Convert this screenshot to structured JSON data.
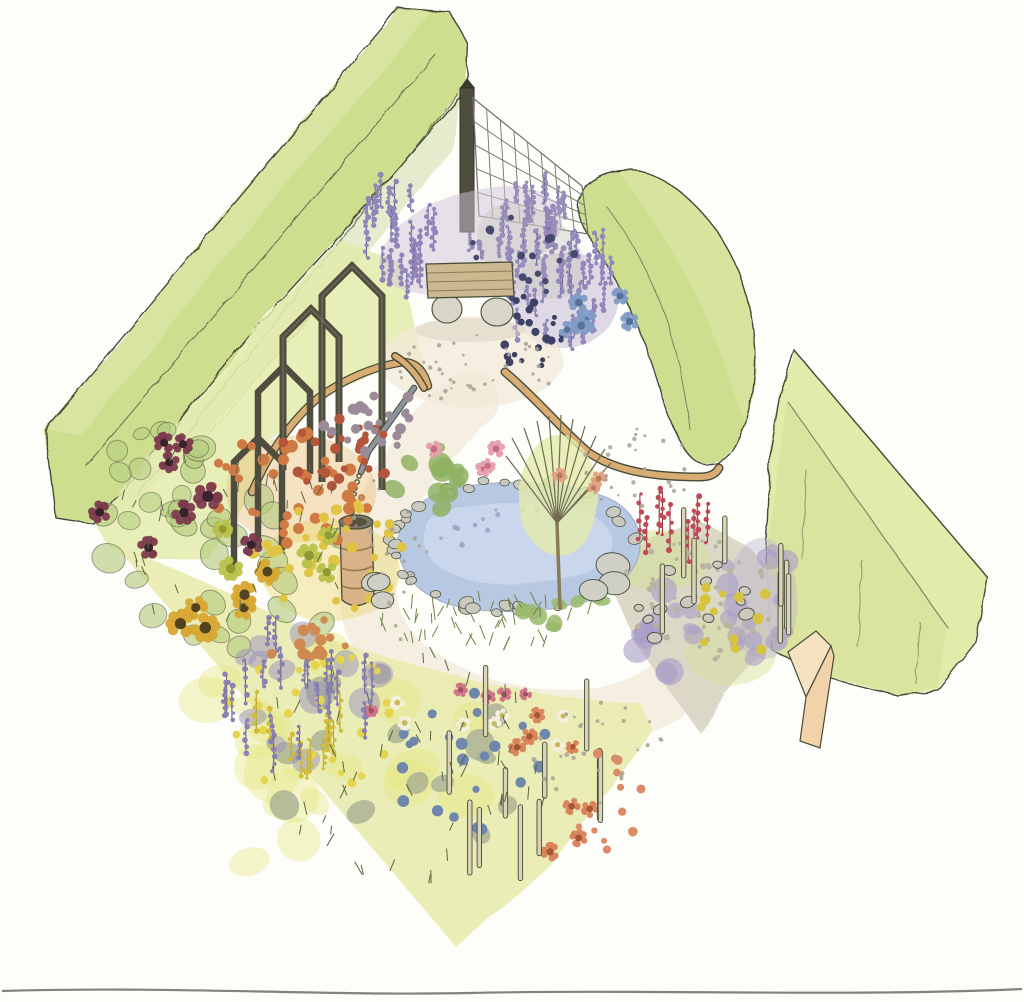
{
  "scene": {
    "description": "watercolor-garden-design-illustration",
    "view": "isometric-diamond-plot"
  },
  "colors": {
    "paper": "#fdfdf9",
    "ink": "#454b38",
    "hedgeMid": "#cede8f",
    "hedgeLight": "#e0eaae",
    "hedgeDark": "#b9cf7b",
    "hedgePale": "#e3ebab",
    "hedgeFace": "#d4e096",
    "wood": "#4f4e3e",
    "woodLight": "#77765f",
    "rail": "#d8ac72",
    "benchWood": "#ccb98f",
    "benchLine": "#8d7c58",
    "stone": "#d9d5c8",
    "barrel": "#d8b488",
    "barrelBand": "#9a7a4e",
    "barrelTop": "#7b7667",
    "pond": "#b7c8e2",
    "pondLight": "#cfdbee",
    "pondLine": "#8291ad",
    "pipe": "#8b939b",
    "wire": "#6e7568",
    "meadow": "#e9ecb0",
    "gravel": "#d9d5c3",
    "plaza": "#f2ead8",
    "pathBand": "#f4efe1",
    "slabTop": "#f6e2c0",
    "slabFront": "#f1d2a9",
    "stake": "#dcd4b6",
    "treeWash": "#e3ecab",
    "trunk": "#8a7a55",
    "branch": "#6e6a4f",
    "scanline": "#73746b",
    "orangeWash": "#e8c07e",
    "yellowWash": "#ecd976",
    "lavenderWash": "#cfc6da",
    "lavenderWash2": "#b9aecd",
    "greyWash": "#c9c3bb"
  },
  "clusters": [
    {
      "layer": "bg",
      "name": "bench-lavender-left",
      "type": "spikes",
      "cx": 400,
      "cy": 250,
      "rx": 46,
      "ry": 48,
      "color": "#8f85b8",
      "color2": "#6b638f",
      "h": 26,
      "count": 26,
      "rmin": 2,
      "rmax": 3
    },
    {
      "layer": "bg",
      "name": "bench-lavender-right",
      "type": "spikes",
      "cx": 556,
      "cy": 298,
      "rx": 58,
      "ry": 62,
      "color": "#9288bb",
      "color2": "#6b638f",
      "h": 28,
      "count": 36,
      "rmin": 2,
      "rmax": 3
    },
    {
      "layer": "bg",
      "name": "fence-slope-sprigs",
      "type": "spikes",
      "cx": 523,
      "cy": 237,
      "rx": 55,
      "ry": 45,
      "color": "#988eb9",
      "color2": "#6f6792",
      "h": 22,
      "count": 24,
      "rmin": 2,
      "rmax": 3
    },
    {
      "layer": "bg",
      "name": "fence-slope-berries",
      "type": "dots",
      "cx": 520,
      "cy": 258,
      "rx": 55,
      "ry": 42,
      "color": "#454a6e",
      "count": 18,
      "rmin": 2.5,
      "rmax": 4.5
    },
    {
      "layer": "bg",
      "name": "bench-berries",
      "type": "dots",
      "cx": 527,
      "cy": 332,
      "rx": 42,
      "ry": 36,
      "color": "#3d4165",
      "count": 26,
      "rmin": 2.5,
      "rmax": 4.5
    },
    {
      "layer": "bg",
      "name": "agapanthus-flowers",
      "type": "daisies",
      "cx": 602,
      "cy": 318,
      "rx": 40,
      "ry": 26,
      "color": "#7f9cc6",
      "color2": "#54719b",
      "count": 6,
      "rmin": 7,
      "rmax": 10
    },
    {
      "layer": "bg",
      "name": "leftbed-leaves",
      "type": "blobs",
      "cx": 215,
      "cy": 560,
      "rx": 130,
      "ry": 115,
      "color": "#b2ca7c",
      "outline": "#4a5138",
      "count": 26,
      "rmin": 9,
      "rmax": 17,
      "opacity": 0.6
    },
    {
      "layer": "bg",
      "name": "leftbed-upper-leaves",
      "type": "blobs",
      "cx": 150,
      "cy": 470,
      "rx": 60,
      "ry": 55,
      "color": "#b3cc7e",
      "outline": "#4a5138",
      "count": 12,
      "rmin": 8,
      "rmax": 13,
      "opacity": 0.55
    },
    {
      "layer": "bg",
      "name": "meadow-yellow-patches",
      "type": "blobs",
      "cx": 340,
      "cy": 760,
      "rx": 170,
      "ry": 125,
      "color": "#e4e77e",
      "count": 20,
      "rmin": 16,
      "rmax": 30,
      "opacity": 0.4
    },
    {
      "layer": "bg",
      "name": "pond-ripples",
      "type": "dots",
      "cx": 500,
      "cy": 528,
      "rx": 70,
      "ry": 22,
      "color": "#93a9c9",
      "count": 12,
      "rmin": 1.5,
      "rmax": 3,
      "opacity": 0.9
    },
    {
      "layer": "bg",
      "name": "pond-stone-ring",
      "type": "ring",
      "cx": 512,
      "cy": 546,
      "rx": 120,
      "ry": 64,
      "color": "#c9c9c0",
      "count": 36,
      "rmin": 4.5,
      "rmax": 8
    },
    {
      "layer": "bg",
      "name": "pond-plants-top",
      "type": "blobs",
      "cx": 425,
      "cy": 480,
      "rx": 58,
      "ry": 34,
      "color": "#8fb163",
      "count": 12,
      "rmin": 7,
      "rmax": 12,
      "opacity": 0.85
    },
    {
      "layer": "bg",
      "name": "pond-plants-bottom",
      "type": "blobs",
      "cx": 560,
      "cy": 608,
      "rx": 60,
      "ry": 24,
      "color": "#9aba6c",
      "count": 10,
      "rmin": 6,
      "rmax": 10,
      "opacity": 0.85
    },
    {
      "layer": "bg",
      "name": "rightbed-lavender",
      "type": "blobs",
      "cx": 685,
      "cy": 635,
      "rx": 75,
      "ry": 48,
      "color": "#a89cc8",
      "count": 16,
      "rmin": 8,
      "rmax": 14,
      "opacity": 0.6
    },
    {
      "layer": "bg",
      "name": "righthedge-lavender",
      "type": "blobs",
      "cx": 757,
      "cy": 600,
      "rx": 42,
      "ry": 60,
      "color": "#a89cc8",
      "count": 12,
      "rmin": 7,
      "rmax": 12,
      "opacity": 0.6
    },
    {
      "layer": "bg",
      "name": "meadow-grey-tufts",
      "type": "blobs",
      "cx": 390,
      "cy": 770,
      "rx": 130,
      "ry": 108,
      "color": "#a9ae94",
      "count": 15,
      "rmin": 9,
      "rmax": 16,
      "opacity": 0.8
    },
    {
      "layer": "bg",
      "name": "meadow-purple-wash",
      "type": "blobs",
      "cx": 302,
      "cy": 700,
      "rx": 85,
      "ry": 72,
      "color": "#9a90bd",
      "count": 12,
      "rmin": 10,
      "rmax": 16,
      "opacity": 0.5
    },
    {
      "layer": "fg",
      "name": "leftbed-orange-flowers",
      "type": "dots",
      "cx": 290,
      "cy": 490,
      "rx": 85,
      "ry": 60,
      "color": "#cf7a43",
      "count": 42,
      "rmin": 3.5,
      "rmax": 6.5
    },
    {
      "layer": "fg",
      "name": "leftbed-rust-flowers",
      "type": "dots",
      "cx": 332,
      "cy": 455,
      "rx": 60,
      "ry": 40,
      "color": "#b5563c",
      "count": 28,
      "rmin": 3,
      "rmax": 5.5
    },
    {
      "layer": "fg",
      "name": "leftbed-yellow-flowers",
      "type": "dots",
      "cx": 330,
      "cy": 560,
      "rx": 80,
      "ry": 62,
      "color": "#e2c445",
      "count": 34,
      "rmin": 3.5,
      "rmax": 6
    },
    {
      "layer": "fg",
      "name": "leftbed-seedheads",
      "type": "dots",
      "cx": 368,
      "cy": 415,
      "rx": 52,
      "ry": 38,
      "color": "#9b8b99",
      "count": 24,
      "rmin": 3,
      "rmax": 5.5
    },
    {
      "layer": "fg",
      "name": "maroon-daisies",
      "type": "daisies",
      "cx": 175,
      "cy": 520,
      "rx": 80,
      "ry": 85,
      "color": "#7c3a4d",
      "color2": "#39222e",
      "count": 8,
      "rmin": 9,
      "rmax": 13
    },
    {
      "layer": "fg",
      "name": "sunflowers",
      "type": "daisies",
      "cx": 230,
      "cy": 600,
      "rx": 75,
      "ry": 46,
      "color": "#d8a832",
      "color2": "#55431f",
      "count": 6,
      "rmin": 9,
      "rmax": 13
    },
    {
      "layer": "fg",
      "name": "pompom-flowers",
      "type": "daisies",
      "cx": 258,
      "cy": 572,
      "rx": 85,
      "ry": 66,
      "color": "#b9c24a",
      "color2": "#8f9a35",
      "count": 5,
      "rmin": 8,
      "rmax": 11
    },
    {
      "layer": "fg",
      "name": "leftbed-stems",
      "type": "ticks",
      "cx": 230,
      "cy": 545,
      "rx": 120,
      "ry": 105,
      "color": "#5c6b42",
      "count": 40,
      "rmin": 7,
      "rmax": 13
    },
    {
      "layer": "fg",
      "name": "pink-flowers",
      "type": "daisies",
      "cx": 470,
      "cy": 455,
      "rx": 42,
      "ry": 15,
      "color": "#e79fae",
      "color2": "#c56e80",
      "count": 4,
      "rmin": 6,
      "rmax": 8
    },
    {
      "layer": "fg",
      "name": "salmon-flowers",
      "type": "daisies",
      "cx": 580,
      "cy": 478,
      "rx": 25,
      "ry": 13,
      "color": "#e0a183",
      "color2": "#b97a5e",
      "count": 3,
      "rmin": 5,
      "rmax": 7
    },
    {
      "layer": "fg",
      "name": "pond-grasses",
      "type": "ticks",
      "cx": 490,
      "cy": 626,
      "rx": 110,
      "ry": 26,
      "color": "#6f8448",
      "count": 46,
      "rmin": 9,
      "rmax": 16
    },
    {
      "layer": "fg",
      "name": "right-boulders",
      "type": "pebbles",
      "cx": 605,
      "cy": 570,
      "rx": 28,
      "ry": 25,
      "color": "#cfcfc6",
      "count": 3,
      "rmin": 14,
      "rmax": 20
    },
    {
      "layer": "fg",
      "name": "left-boulders",
      "type": "pebbles",
      "cx": 392,
      "cy": 585,
      "rx": 22,
      "ry": 20,
      "color": "#cfcfc6",
      "count": 3,
      "rmin": 10,
      "rmax": 15
    },
    {
      "layer": "fg",
      "name": "red-flower-spikes",
      "type": "spikes",
      "cx": 672,
      "cy": 548,
      "rx": 40,
      "ry": 16,
      "color": "#bf4a57",
      "color2": "#8f3642",
      "h": 46,
      "count": 9,
      "rmin": 2,
      "rmax": 3
    },
    {
      "layer": "fg",
      "name": "rightbed-gravel",
      "type": "dots",
      "cx": 700,
      "cy": 600,
      "rx": 85,
      "ry": 60,
      "color": "#b9b3a1",
      "count": 60,
      "rmin": 1.6,
      "rmax": 3.2
    },
    {
      "layer": "fg",
      "name": "rightbed-pebbles",
      "type": "pebbles",
      "cx": 690,
      "cy": 598,
      "rx": 70,
      "ry": 48,
      "color": "#ccc9bd",
      "count": 12,
      "rmin": 4.5,
      "rmax": 8
    },
    {
      "layer": "fg",
      "name": "rightbed-yellow-flowers",
      "type": "dots",
      "cx": 722,
      "cy": 618,
      "rx": 58,
      "ry": 44,
      "color": "#d8c33c",
      "count": 12,
      "rmin": 3.5,
      "rmax": 5.5
    },
    {
      "layer": "fg",
      "name": "rightbed-stakes",
      "type": "stakes",
      "cx": 728,
      "cy": 612,
      "rx": 75,
      "ry": 52,
      "color": "#dcd4b6",
      "h": 62,
      "count": 8,
      "rmin": 2,
      "rmax": 3
    },
    {
      "layer": "fg",
      "name": "meadow-blue-globes",
      "type": "dots",
      "cx": 470,
      "cy": 760,
      "rx": 85,
      "ry": 72,
      "color": "#7087ad",
      "count": 22,
      "rmin": 3.5,
      "rmax": 6
    },
    {
      "layer": "fg",
      "name": "meadow-orange-daisies",
      "type": "daisies",
      "cx": 560,
      "cy": 792,
      "rx": 68,
      "ry": 82,
      "color": "#d9825a",
      "color2": "#a85636",
      "count": 8,
      "rmin": 6,
      "rmax": 8.5
    },
    {
      "layer": "fg",
      "name": "meadow-yellow-dots",
      "type": "dots",
      "cx": 310,
      "cy": 715,
      "rx": 95,
      "ry": 78,
      "color": "#e5d44e",
      "count": 26,
      "rmin": 3,
      "rmax": 5
    },
    {
      "layer": "fg",
      "name": "meadow-pink-daisies",
      "type": "daisies",
      "cx": 445,
      "cy": 700,
      "rx": 110,
      "ry": 16,
      "color": "#cf7287",
      "color2": "#a34f63",
      "count": 5,
      "rmin": 5,
      "rmax": 7
    },
    {
      "layer": "fg",
      "name": "meadow-white-daisies",
      "type": "daisies",
      "cx": 490,
      "cy": 716,
      "rx": 110,
      "ry": 46,
      "color": "#f4f0e2",
      "color2": "#c9ba55",
      "count": 7,
      "rmin": 5,
      "rmax": 7
    },
    {
      "layer": "fg",
      "name": "goldenrod-spikes",
      "type": "spikes",
      "cx": 300,
      "cy": 742,
      "rx": 46,
      "ry": 40,
      "color": "#d2bc3e",
      "color2": "#b3a02e",
      "h": 30,
      "count": 12,
      "rmin": 2,
      "rmax": 3
    },
    {
      "layer": "fg",
      "name": "meadow-stakes",
      "type": "stakes",
      "cx": 520,
      "cy": 812,
      "rx": 105,
      "ry": 82,
      "color": "#dcd4b6",
      "h": 62,
      "count": 11,
      "rmin": 2,
      "rmax": 3
    },
    {
      "layer": "fg",
      "name": "meadow-stems",
      "type": "ticks",
      "cx": 400,
      "cy": 770,
      "rx": 150,
      "ry": 118,
      "color": "#59663f",
      "count": 55,
      "rmin": 8,
      "rmax": 15
    },
    {
      "layer": "fg",
      "name": "meadow-purple-spikes",
      "type": "spikes",
      "cx": 305,
      "cy": 705,
      "rx": 85,
      "ry": 72,
      "color": "#8b80b2",
      "color2": "#675e8c",
      "h": 34,
      "count": 22,
      "rmin": 2,
      "rmax": 3
    },
    {
      "layer": "fg",
      "name": "orange-trail",
      "type": "dots",
      "cx": 300,
      "cy": 642,
      "rx": 55,
      "ry": 26,
      "color": "#d08a4f",
      "count": 14,
      "rmin": 3.5,
      "rmax": 6
    },
    {
      "layer": "fg",
      "name": "meadow-salmon-poppies",
      "type": "dots",
      "cx": 600,
      "cy": 800,
      "rx": 42,
      "ry": 52,
      "color": "#dd8a66",
      "count": 12,
      "rmin": 3,
      "rmax": 5
    },
    {
      "layer": "fg",
      "name": "plaza-specks",
      "type": "dots",
      "cx": 475,
      "cy": 370,
      "rx": 80,
      "ry": 36,
      "color": "#a9a292",
      "count": 40,
      "rmin": 1.2,
      "rmax": 2.4,
      "opacity": 0.85
    },
    {
      "layer": "fg",
      "name": "path-specks-left",
      "type": "dots",
      "cx": 388,
      "cy": 560,
      "rx": 42,
      "ry": 85,
      "color": "#a9a292",
      "count": 24,
      "rmin": 1.2,
      "rmax": 2.4,
      "opacity": 0.85
    },
    {
      "layer": "fg",
      "name": "path-specks-upper-right",
      "type": "dots",
      "cx": 640,
      "cy": 470,
      "rx": 60,
      "ry": 42,
      "color": "#a9a292",
      "count": 26,
      "rmin": 1.2,
      "rmax": 2.4,
      "opacity": 0.85
    },
    {
      "layer": "fg",
      "name": "path-specks-bottom",
      "type": "dots",
      "cx": 600,
      "cy": 748,
      "rx": 68,
      "ry": 55,
      "color": "#a9a292",
      "count": 30,
      "rmin": 1.2,
      "rmax": 2.4,
      "opacity": 0.85
    }
  ]
}
